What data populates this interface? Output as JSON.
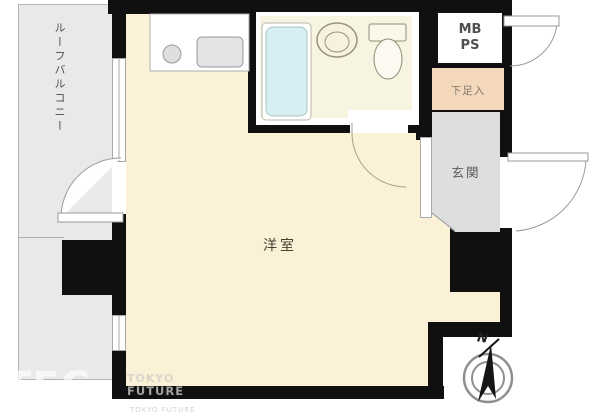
{
  "floorplan": {
    "labels": {
      "balcony": "ルーフバルコニー",
      "room": "洋室",
      "entrance": "玄関",
      "shoe_cabinet": "下足入",
      "meter_box": "MB",
      "pipe_shaft": "PS",
      "compass_north": "N"
    },
    "watermark": {
      "big": "TEC",
      "line1": "TOKYO",
      "line2": "FUTURE",
      "small": "TOKYO FUTURE"
    },
    "colors": {
      "wall": "#101010",
      "room_fill": "#FAF1D7",
      "bath_fill": "#F8F4E2",
      "balcony_fill": "#E9E9EB",
      "entrance_fill": "#DEDEE0",
      "shoe_fill": "#F4D8BB",
      "tub_fill": "#D7EFF2",
      "outline": "#999999"
    }
  }
}
